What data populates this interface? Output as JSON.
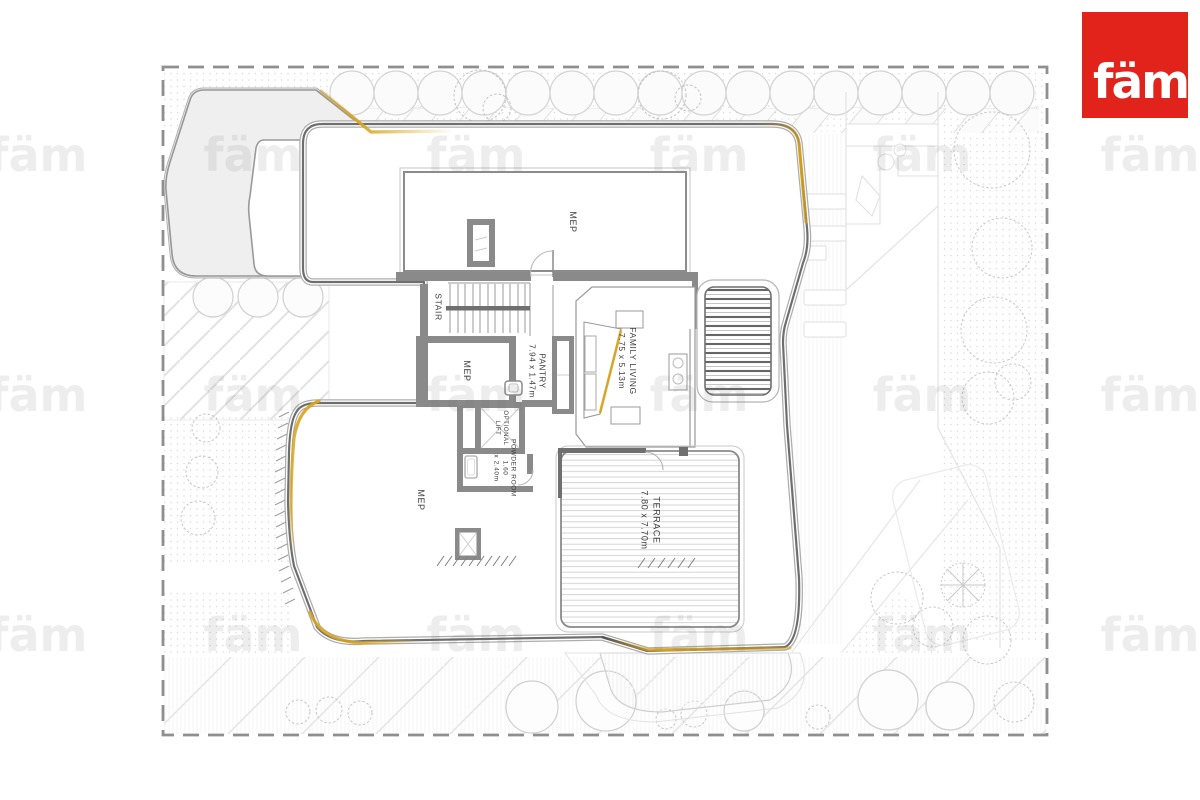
{
  "brand": {
    "logo_text": "fäm",
    "registered_mark": "®",
    "logo_bg": "#E2231C",
    "logo_fg": "#FFFFFF"
  },
  "watermark": {
    "text": "fäm",
    "positions": [
      [
        38,
        155
      ],
      [
        253,
        155
      ],
      [
        476,
        155
      ],
      [
        699,
        155
      ],
      [
        922,
        155
      ],
      [
        1150,
        155
      ],
      [
        38,
        395
      ],
      [
        253,
        395
      ],
      [
        476,
        395
      ],
      [
        699,
        395
      ],
      [
        922,
        395
      ],
      [
        1150,
        395
      ],
      [
        38,
        635
      ],
      [
        253,
        635
      ],
      [
        476,
        635
      ],
      [
        699,
        635
      ],
      [
        922,
        635
      ],
      [
        1150,
        635
      ]
    ]
  },
  "plan": {
    "accent_color": "#D8A41F",
    "wall_color": "#8a8a8a",
    "rooms": [
      {
        "id": "mep-upper",
        "x": 572,
        "y": 222,
        "size": 9,
        "lines": [
          "MEP"
        ]
      },
      {
        "id": "stair",
        "x": 438,
        "y": 307,
        "size": 8.5,
        "lines": [
          "STAIR"
        ]
      },
      {
        "id": "mep-middle",
        "x": 466,
        "y": 371,
        "size": 9,
        "lines": [
          "MEP"
        ]
      },
      {
        "id": "pantry",
        "x": 536,
        "y": 371,
        "size": 8,
        "lines": [
          "PANTRY",
          "7.94 x 1.47m"
        ]
      },
      {
        "id": "family-living",
        "x": 627,
        "y": 361,
        "size": 8.5,
        "lines": [
          "FAMILY LIVING",
          "7.75 x 5.13m"
        ]
      },
      {
        "id": "optional-lift",
        "x": 500,
        "y": 428,
        "size": 6,
        "lines": [
          "OPTIONAL",
          "LIFT"
        ]
      },
      {
        "id": "powder-room",
        "x": 504,
        "y": 468,
        "size": 6.5,
        "lines": [
          "POWDER ROOM",
          "1.60",
          "x 2.40m"
        ]
      },
      {
        "id": "mep-lower",
        "x": 420,
        "y": 500,
        "size": 9,
        "lines": [
          "MEP"
        ]
      },
      {
        "id": "terrace",
        "x": 650,
        "y": 520,
        "size": 9,
        "lines": [
          "TERRACE",
          "7.80 x 7.70m"
        ]
      }
    ]
  }
}
